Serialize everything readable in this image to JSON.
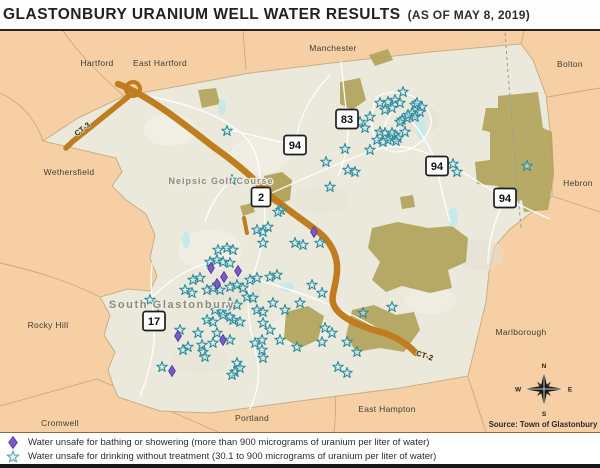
{
  "title": {
    "main": "GLASTONBURY URANIUM WELL WATER RESULTS",
    "suffix": "(AS OF MAY 8, 2019)"
  },
  "source": "Source: Town of Glastonbury",
  "legend": {
    "items": [
      {
        "icon": "purple-diamond",
        "text": "Water unsafe for bathing or showering (more than 900 micrograms of uranium per liter of water)"
      },
      {
        "icon": "teal-star",
        "text": "Water unsafe for drinking without treatment (30.1 to 900 micrograms of uranium per liter of water)"
      }
    ]
  },
  "map": {
    "colors": {
      "outside_towns": "#f6d0a4",
      "glastonbury_fill": "#ebe9dc",
      "forest": "#b2a45c",
      "highway": "#bf7d1f",
      "minor_road": "#ffffff",
      "water": "#c9e9e9",
      "star_stroke": "#2f8d9e",
      "star_fill": "#cfe7ea",
      "diamond_fill": "#7a59c8"
    },
    "town_labels": [
      {
        "text": "Hartford",
        "x": 97,
        "y": 66
      },
      {
        "text": "East Hartford",
        "x": 160,
        "y": 66
      },
      {
        "text": "Manchester",
        "x": 333,
        "y": 51
      },
      {
        "text": "Bolton",
        "x": 570,
        "y": 67
      },
      {
        "text": "Wethersfield",
        "x": 69,
        "y": 175
      },
      {
        "text": "Hebron",
        "x": 578,
        "y": 186
      },
      {
        "text": "Rocky Hill",
        "x": 48,
        "y": 328
      },
      {
        "text": "Marlborough",
        "x": 521,
        "y": 335
      },
      {
        "text": "Cromwell",
        "x": 60,
        "y": 426
      },
      {
        "text": "Portland",
        "x": 252,
        "y": 421
      },
      {
        "text": "East Hampton",
        "x": 387,
        "y": 412
      }
    ],
    "place_labels": [
      {
        "text": "Neipsic Golf Course",
        "x": 221,
        "y": 184,
        "size": 9,
        "ls": 1
      },
      {
        "text": "South Glastonbury",
        "x": 172,
        "y": 308,
        "size": 11,
        "ls": 1.6
      }
    ],
    "route_shields": [
      {
        "label": "2",
        "x": 261,
        "y": 197
      },
      {
        "label": "83",
        "x": 347,
        "y": 119
      },
      {
        "label": "94",
        "x": 295,
        "y": 145
      },
      {
        "label": "94",
        "x": 437,
        "y": 166
      },
      {
        "label": "94",
        "x": 505,
        "y": 198
      },
      {
        "label": "17",
        "x": 154,
        "y": 321
      }
    ],
    "road_labels": [
      {
        "text": "CT-3",
        "x": 84,
        "y": 131,
        "angle": -38
      },
      {
        "text": "CT-2",
        "x": 424,
        "y": 358,
        "angle": 18
      }
    ],
    "compass": {
      "x": 544,
      "y": 389,
      "n": "N",
      "e": "E",
      "s": "S",
      "w": "W"
    },
    "markers": {
      "stars": [
        [
          403,
          92
        ],
        [
          380,
          103
        ],
        [
          388,
          102
        ],
        [
          395,
          100
        ],
        [
          400,
          103
        ],
        [
          385,
          110
        ],
        [
          392,
          108
        ],
        [
          415,
          105
        ],
        [
          417,
          103
        ],
        [
          422,
          107
        ],
        [
          412,
          113
        ],
        [
          415,
          117
        ],
        [
          402,
          120
        ],
        [
          407,
          118
        ],
        [
          370,
          117
        ],
        [
          408,
          115
        ],
        [
          420,
          112
        ],
        [
          400,
          122
        ],
        [
          365,
          128
        ],
        [
          360,
          122
        ],
        [
          380,
          132
        ],
        [
          385,
          133
        ],
        [
          390,
          137
        ],
        [
          395,
          135
        ],
        [
          392,
          133
        ],
        [
          398,
          138
        ],
        [
          396,
          141
        ],
        [
          388,
          140
        ],
        [
          377,
          140
        ],
        [
          383,
          142
        ],
        [
          405,
          132
        ],
        [
          345,
          149
        ],
        [
          348,
          170
        ],
        [
          355,
          172
        ],
        [
          326,
          162
        ],
        [
          370,
          150
        ],
        [
          227,
          131
        ],
        [
          453,
          164
        ],
        [
          457,
          172
        ],
        [
          527,
          166
        ],
        [
          330,
          187
        ],
        [
          281,
          210
        ],
        [
          232,
          180
        ],
        [
          278,
          212
        ],
        [
          257,
          230
        ],
        [
          263,
          232
        ],
        [
          268,
          227
        ],
        [
          263,
          243
        ],
        [
          295,
          243
        ],
        [
          303,
          245
        ],
        [
          320,
          243
        ],
        [
          218,
          250
        ],
        [
          227,
          248
        ],
        [
          233,
          250
        ],
        [
          210,
          262
        ],
        [
          217,
          260
        ],
        [
          223,
          262
        ],
        [
          230,
          263
        ],
        [
          193,
          280
        ],
        [
          200,
          278
        ],
        [
          185,
          290
        ],
        [
          192,
          293
        ],
        [
          207,
          290
        ],
        [
          213,
          288
        ],
        [
          220,
          290
        ],
        [
          230,
          287
        ],
        [
          237,
          285
        ],
        [
          243,
          288
        ],
        [
          250,
          280
        ],
        [
          257,
          278
        ],
        [
          270,
          277
        ],
        [
          277,
          275
        ],
        [
          247,
          297
        ],
        [
          253,
          298
        ],
        [
          230,
          303
        ],
        [
          237,
          305
        ],
        [
          215,
          310
        ],
        [
          222,
          312
        ],
        [
          207,
          320
        ],
        [
          213,
          322
        ],
        [
          233,
          320
        ],
        [
          240,
          322
        ],
        [
          257,
          310
        ],
        [
          263,
          312
        ],
        [
          273,
          303
        ],
        [
          285,
          310
        ],
        [
          300,
          303
        ],
        [
          312,
          285
        ],
        [
          322,
          293
        ],
        [
          270,
          330
        ],
        [
          280,
          340
        ],
        [
          255,
          343
        ],
        [
          230,
          340
        ],
        [
          213,
          343
        ],
        [
          198,
          333
        ],
        [
          180,
          330
        ],
        [
          158,
          315
        ],
        [
          150,
          300
        ],
        [
          322,
          342
        ],
        [
          297,
          347
        ],
        [
          188,
          347
        ],
        [
          263,
          323
        ],
        [
          262,
          340
        ],
        [
          263,
          358
        ],
        [
          217,
          333
        ],
        [
          235,
          372
        ],
        [
          262,
          350
        ],
        [
          325,
          328
        ],
        [
          332,
          333
        ],
        [
          347,
          342
        ],
        [
          357,
          352
        ],
        [
          363,
          313
        ],
        [
          338,
          367
        ],
        [
          347,
          373
        ],
        [
          392,
          307
        ],
        [
          162,
          367
        ],
        [
          202,
          345
        ],
        [
          203,
          352
        ],
        [
          205,
          357
        ],
        [
          230,
          317
        ],
        [
          223,
          315
        ],
        [
          237,
          363
        ],
        [
          240,
          368
        ],
        [
          232,
          375
        ],
        [
          183,
          350
        ]
      ],
      "diamonds": [
        [
          211,
          268
        ],
        [
          224,
          277
        ],
        [
          238,
          271
        ],
        [
          217,
          284
        ],
        [
          314,
          232
        ],
        [
          178,
          336
        ],
        [
          223,
          340
        ],
        [
          172,
          371
        ]
      ]
    }
  }
}
